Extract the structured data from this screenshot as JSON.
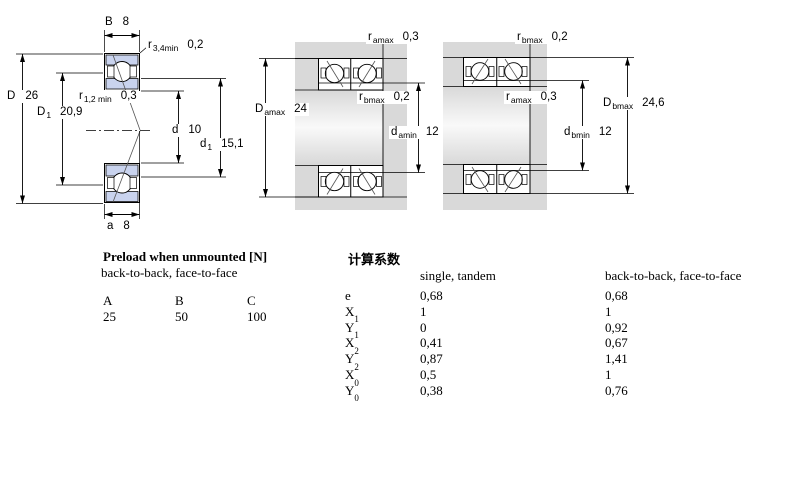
{
  "figures": {
    "left": {
      "labels": {
        "B": {
          "sym": "B",
          "sub": "",
          "val": "8"
        },
        "r34": {
          "sym": "r",
          "sub": "3,4min",
          "val": "0,2"
        },
        "D": {
          "sym": "D",
          "sub": "",
          "val": "26"
        },
        "r12": {
          "sym": "r",
          "sub": "1,2 min",
          "val": "0,3"
        },
        "D1": {
          "sym": "D",
          "sub": "1",
          "val": "20,9"
        },
        "d": {
          "sym": "d",
          "sub": "",
          "val": "10"
        },
        "d1": {
          "sym": "d",
          "sub": "1",
          "val": "15,1"
        },
        "a": {
          "sym": "a",
          "sub": "",
          "val": "8"
        }
      }
    },
    "middle": {
      "labels": {
        "ramax": {
          "sym": "r",
          "sub": "amax",
          "val": "0,3"
        },
        "rbmax": {
          "sym": "r",
          "sub": "bmax",
          "val": "0,2"
        },
        "Damax": {
          "sym": "D",
          "sub": "amax",
          "val": "24"
        },
        "damin": {
          "sym": "d",
          "sub": "amin",
          "val": "12"
        }
      }
    },
    "right": {
      "labels": {
        "rbmax": {
          "sym": "r",
          "sub": "bmax",
          "val": "0,2"
        },
        "ramax": {
          "sym": "r",
          "sub": "amax",
          "val": "0,3"
        },
        "Dbmax": {
          "sym": "D",
          "sub": "bmax",
          "val": "24,6"
        },
        "dbmin": {
          "sym": "d",
          "sub": "bmin",
          "val": "12"
        }
      }
    }
  },
  "preload_table": {
    "title": "Preload when unmounted [N]",
    "subtitle": "back-to-back, face-to-face",
    "columns": [
      "A",
      "B",
      "C"
    ],
    "values": [
      "25",
      "50",
      "100"
    ]
  },
  "factors_table": {
    "title": "计算系数",
    "col1_header": "single, tandem",
    "col2_header": "back-to-back, face-to-face",
    "rows": [
      {
        "sym": "e",
        "sub": "",
        "v1": "0,68",
        "v2": "0,68"
      },
      {
        "sym": "X",
        "sub": "1",
        "v1": "1",
        "v2": "1"
      },
      {
        "sym": "Y",
        "sub": "1",
        "v1": "0",
        "v2": "0,92"
      },
      {
        "sym": "X",
        "sub": "2",
        "v1": "0,41",
        "v2": "0,67"
      },
      {
        "sym": "Y",
        "sub": "2",
        "v1": "0,87",
        "v2": "1,41"
      },
      {
        "sym": "X",
        "sub": "0",
        "v1": "0,5",
        "v2": "1"
      },
      {
        "sym": "Y",
        "sub": "0",
        "v1": "0,38",
        "v2": "0,76"
      }
    ]
  },
  "colors": {
    "ring_fill": "#c9d3ee",
    "housing_gray": "#d9d9d9",
    "line": "#000000"
  }
}
